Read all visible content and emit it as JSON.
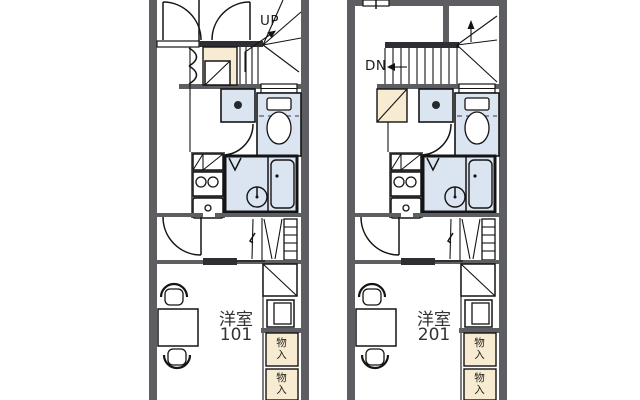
{
  "colors": {
    "wall_gray": "#5c5e62",
    "step_dark": "#2d2f33",
    "storage_cream": "#f7ebd1",
    "sanitary_blue": "#dbe5f2",
    "line_black": "#141414"
  },
  "plan_left": {
    "stairs_label": "UP",
    "room_name": "洋室",
    "room_number": "101",
    "storage_top": "物入",
    "storage_bottom": "物入"
  },
  "plan_right": {
    "stairs_label": "DN",
    "room_name": "洋室",
    "room_number": "201",
    "storage_top": "物入",
    "storage_bottom": "物入"
  }
}
